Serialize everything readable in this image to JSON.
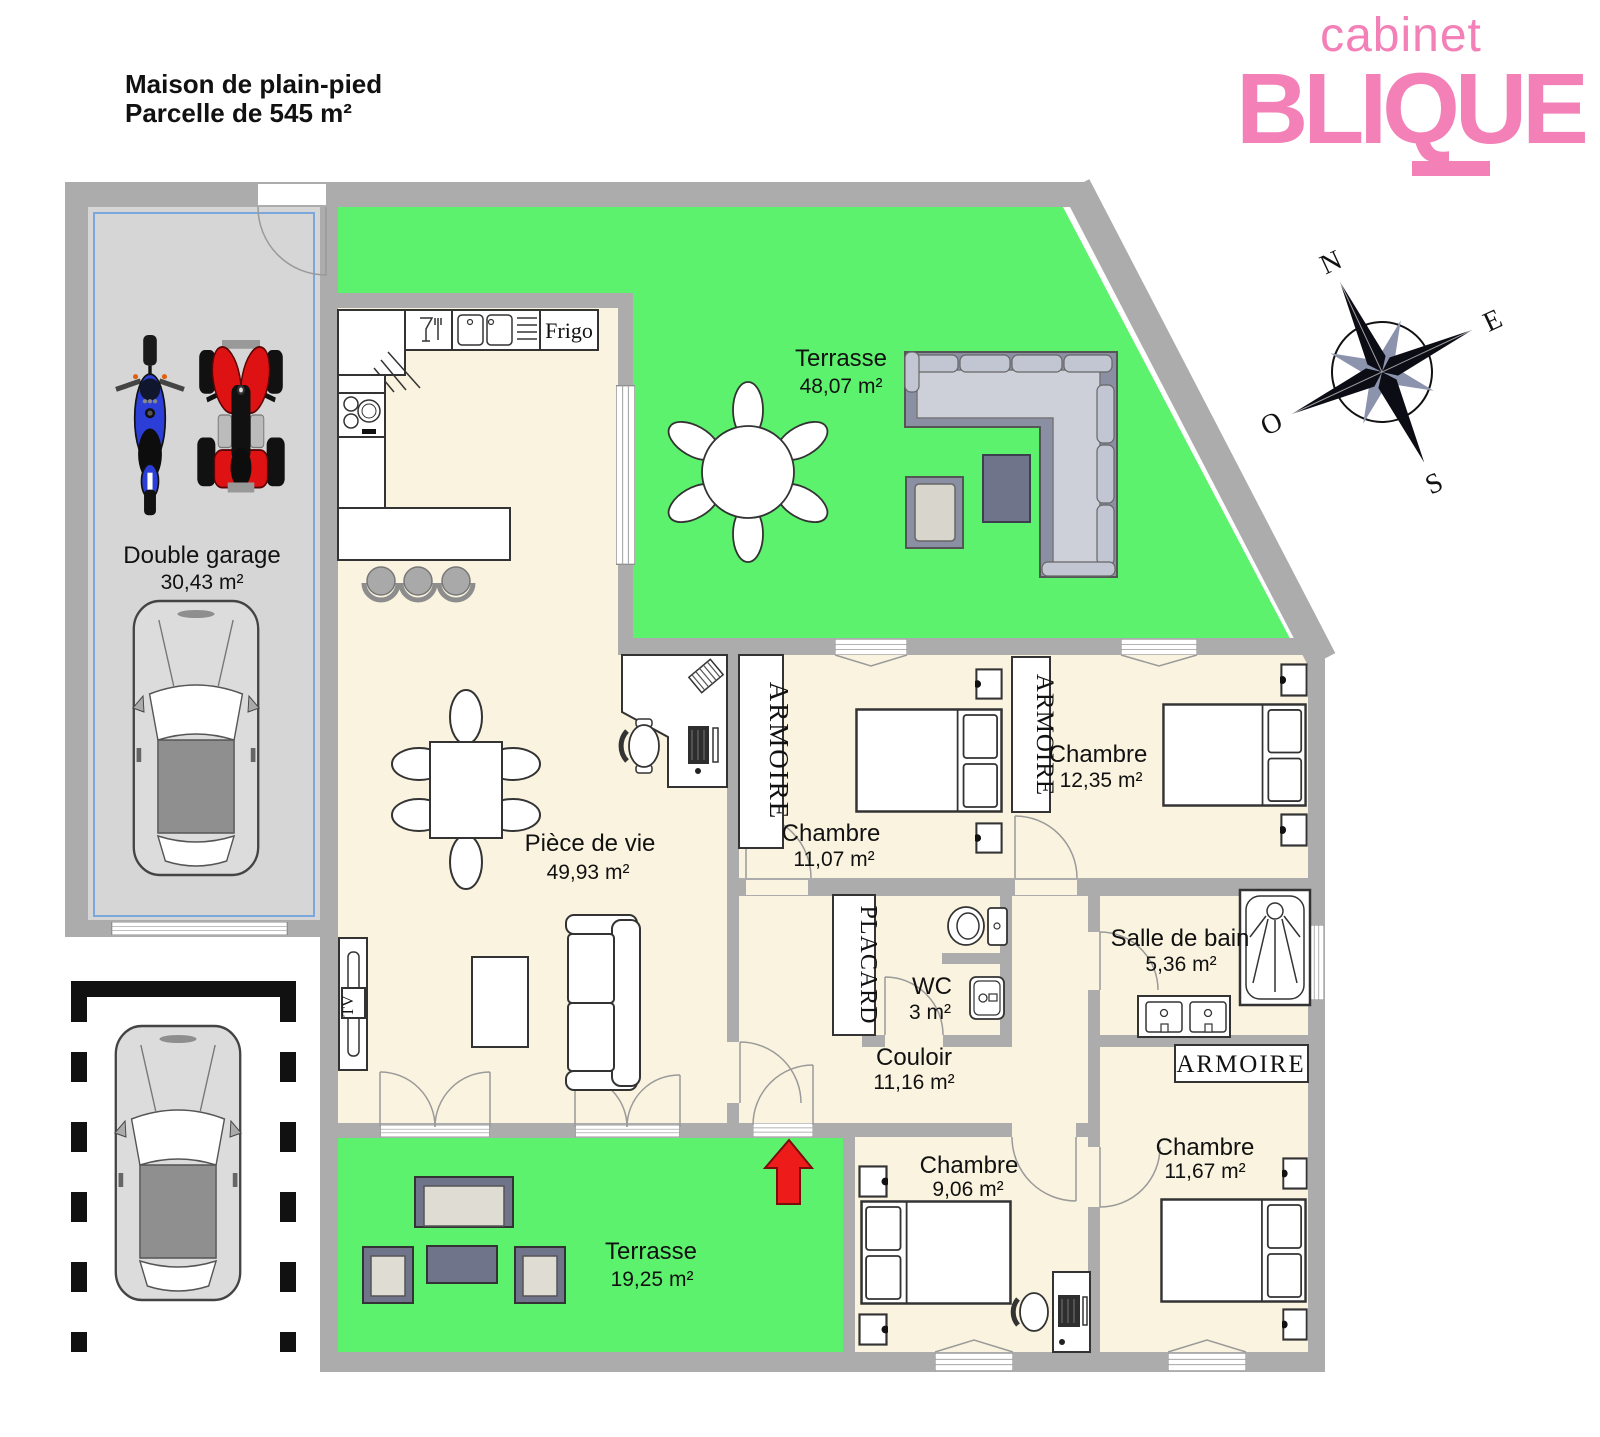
{
  "title": {
    "line1": "Maison de plain-pied",
    "line2": "Parcelle de 545 m²"
  },
  "logo": {
    "brand_top": "cabinet",
    "brand_name": "BLIQUE"
  },
  "compass": {
    "n": "N",
    "e": "E",
    "s": "S",
    "o": "O"
  },
  "rooms": {
    "garage": {
      "name": "Double garage",
      "area": "30,43 m²"
    },
    "terrace_top": {
      "name": "Terrasse",
      "area": "48,07 m²"
    },
    "living": {
      "name": "Pièce de vie",
      "area": "49,93 m²"
    },
    "bedroom1": {
      "name": "Chambre",
      "area": "11,07 m²"
    },
    "bedroom2": {
      "name": "Chambre",
      "area": "12,35 m²"
    },
    "bathroom": {
      "name": "Salle de bain",
      "area": "5,36 m²"
    },
    "wc": {
      "name": "WC",
      "area": "3 m²"
    },
    "hallway": {
      "name": "Couloir",
      "area": "11,16 m²"
    },
    "bedroom3": {
      "name": "Chambre",
      "area": "9,06 m²"
    },
    "bedroom4": {
      "name": "Chambre",
      "area": "11,67 m²"
    },
    "terrace_bottom": {
      "name": "Terrasse",
      "area": "19,25 m²"
    }
  },
  "fixtures": {
    "wardrobe_bedroom1": "ARMOIRE",
    "wardrobe_bedroom2": "ARMOIRE",
    "wardrobe_bedroom4": "ARMOIRE",
    "closet_hallway": "PLACARD",
    "fridge": "Frigo",
    "tv": "TV"
  },
  "colors": {
    "wall": "#ACACAC",
    "floor": "#FAF3DF",
    "grass": "#5CF26D",
    "garage_floor": "#D6D6D6",
    "logo_pink": "#F380B7",
    "arrow_red": "#ED1C1A",
    "moto_blue": "#2B3FD8",
    "quad_red": "#DE1212",
    "outdoor_sofa_gray": "#8A8FA3",
    "outdoor_frame_dark": "#70748A"
  }
}
